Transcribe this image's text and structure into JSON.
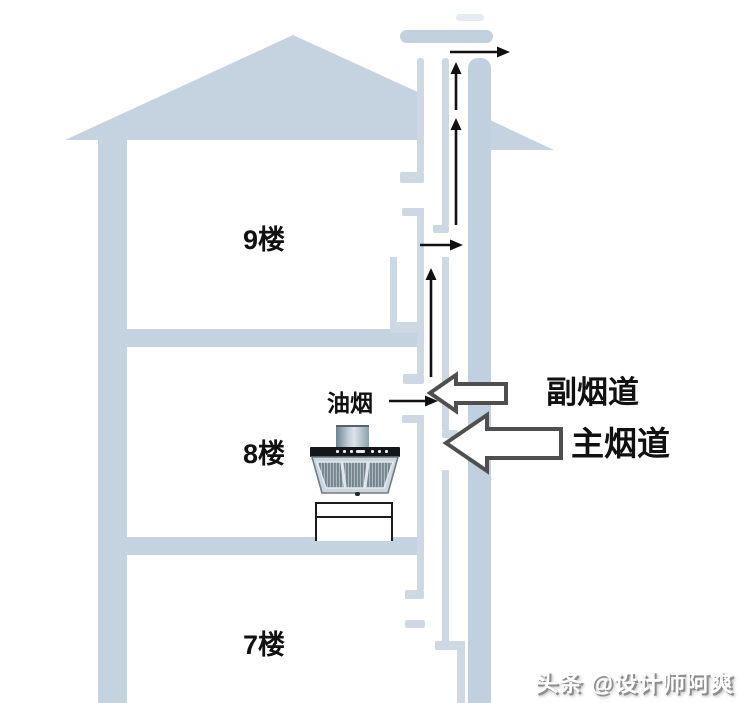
{
  "diagram": {
    "floors": [
      {
        "label": "9楼"
      },
      {
        "label": "8楼"
      },
      {
        "label": "7楼"
      }
    ],
    "labels": {
      "fume": "油烟",
      "secondary_duct": "副烟道",
      "main_duct": "主烟道"
    },
    "watermark": "头条 @设计师阿爽",
    "colors": {
      "structure": "#c5d3e0",
      "duct_wall_thin": "#cdd8e3",
      "duct_main_band": "#c1d0df",
      "duct_cap": "#c3d1df",
      "duct_dash_faint": "#e4ebf1",
      "flow_arrow": "#111111",
      "hollow_arrow_outline": "#4f4f4f",
      "hollow_arrow_fill": "#ffffff",
      "label_text": "#111111",
      "watermark_text": "#ffffff",
      "hood_bar": "#14171a",
      "counter_line": "#1b1b1b"
    }
  }
}
